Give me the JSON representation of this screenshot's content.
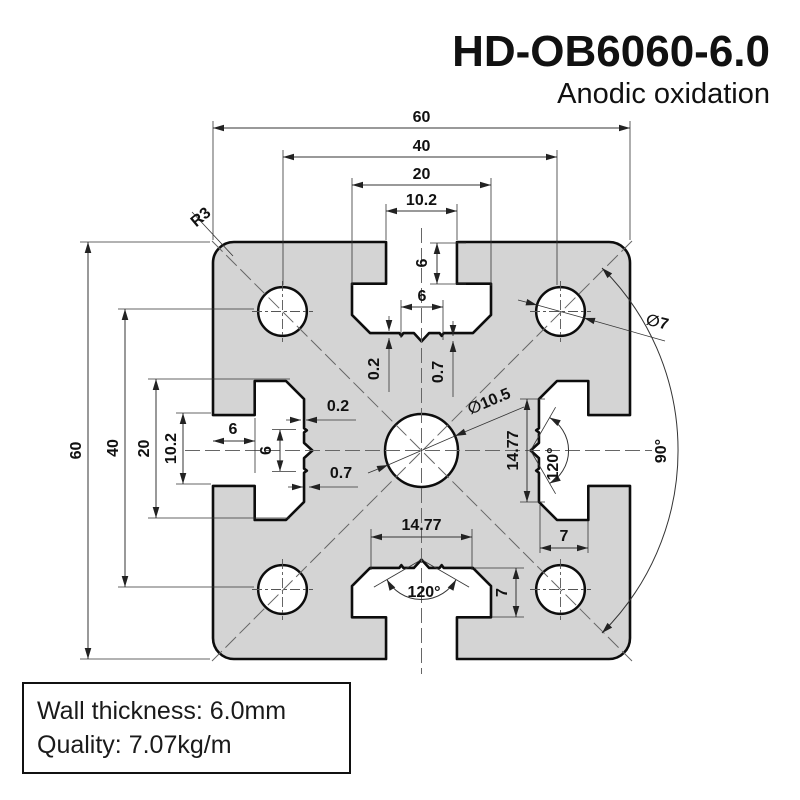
{
  "title": "HD-OB6060-6.0",
  "subtitle": "Anodic oxidation",
  "note": {
    "wall_thickness": "Wall thickness: 6.0mm",
    "quality": "Quality: 7.07kg/m"
  },
  "dims": {
    "top": {
      "d60": "60",
      "d40": "40",
      "d20": "20",
      "d10_2": "10.2"
    },
    "left": {
      "d60": "60",
      "d40": "40",
      "d20": "20",
      "d10_2": "10.2"
    },
    "slot_top": {
      "depth": "6",
      "width": "6",
      "s02": "0.2",
      "s07": "0.7"
    },
    "slot_left": {
      "depth": "6",
      "width": "6",
      "s02": "0.2",
      "s07": "0.7"
    },
    "slot_bottom": {
      "width": "14.77",
      "angle": "120°",
      "step": "7"
    },
    "slot_right": {
      "width": "14.77",
      "angle": "120°",
      "step": "7"
    },
    "center_hole_dia": "∅10.5",
    "corner_hole_dia": "∅7",
    "corner_radius": "R3",
    "quadrant_angle": "90°"
  },
  "colors": {
    "profile_fill": "#d4d4d4",
    "outline": "#0d0d0d",
    "dim_line": "#333333",
    "centerline": "#666666",
    "text": "#111111"
  }
}
